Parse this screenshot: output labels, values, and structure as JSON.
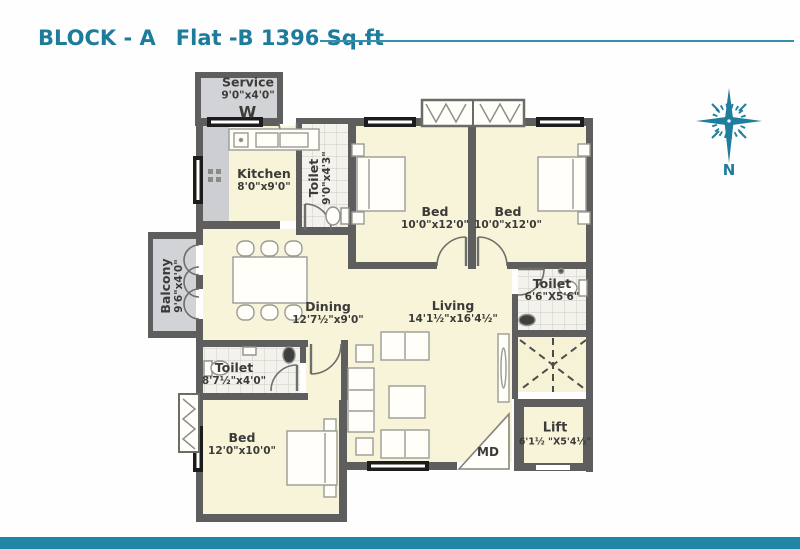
{
  "header": {
    "block": "BLOCK - A",
    "flat": "Flat -B 1396 Sq.ft"
  },
  "compass": {
    "north": "N"
  },
  "rooms": {
    "service": {
      "name": "Service",
      "dims": "9'0\"x4'0\"",
      "washer": "W"
    },
    "kitchen": {
      "name": "Kitchen",
      "dims": "8'0\"x9'0\""
    },
    "toilet_top": {
      "name": "Toilet",
      "dims": "9'0\"x4'3\""
    },
    "bed_top_left": {
      "name": "Bed",
      "dims": "10'0\"x12'0\""
    },
    "bed_top_right": {
      "name": "Bed",
      "dims": "10'0\"x12'0\""
    },
    "toilet_right": {
      "name": "Toilet",
      "dims": "6'6\"X5'6\""
    },
    "lift": {
      "name": "Lift",
      "dims": "6'1½ \"X5'4½\""
    },
    "balcony": {
      "name": "Balcony",
      "dims": "9'6\"x4'0\""
    },
    "dining": {
      "name": "Dining",
      "dims": "12'7½\"x9'0\""
    },
    "living": {
      "name": "Living",
      "dims": "14'1½\"x16'4½\""
    },
    "toilet_bottom": {
      "name": "Toilet",
      "dims": "8'7½\"x4'0\""
    },
    "bed_bottom": {
      "name": "Bed",
      "dims": "12'0\"x10'0\""
    },
    "main_door": {
      "label": "MD"
    }
  },
  "colors": {
    "accent": "#1d7b9c",
    "wall": "#5e5e5e",
    "floor": "#f8f4da",
    "utility_floor": "#d2d3d7",
    "bottom_bar": "#1f86a6"
  }
}
